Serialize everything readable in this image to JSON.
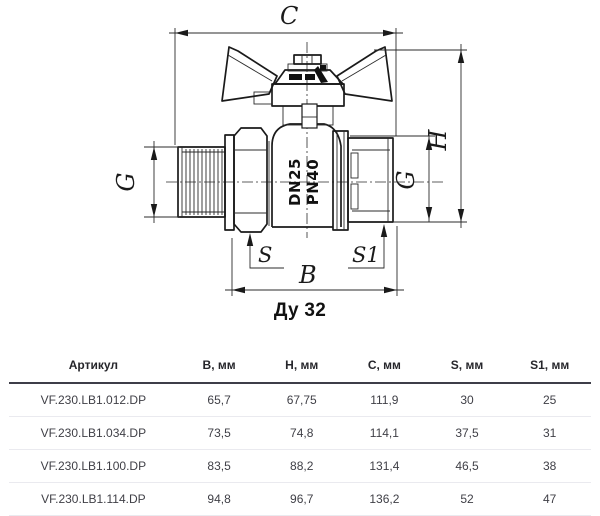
{
  "title": "Ду 32",
  "drawing": {
    "labels": {
      "c": "C",
      "h": "H",
      "g_left": "G",
      "g_right": "G",
      "s": "S",
      "s1": "S1",
      "b": "B"
    },
    "marking": {
      "line1": "PN40",
      "line2": "DN25"
    }
  },
  "table": {
    "columns": [
      "Артикул",
      "B, мм",
      "H, мм",
      "C, мм",
      "S, мм",
      "S1, мм"
    ],
    "rows": [
      [
        "VF.230.LB1.012.DP",
        "65,7",
        "67,75",
        "111,9",
        "30",
        "25"
      ],
      [
        "VF.230.LB1.034.DP",
        "73,5",
        "74,8",
        "114,1",
        "37,5",
        "31"
      ],
      [
        "VF.230.LB1.100.DP",
        "83,5",
        "88,2",
        "131,4",
        "46,5",
        "38"
      ],
      [
        "VF.230.LB1.114.DP",
        "94,8",
        "96,7",
        "136,2",
        "52",
        "47"
      ]
    ]
  }
}
